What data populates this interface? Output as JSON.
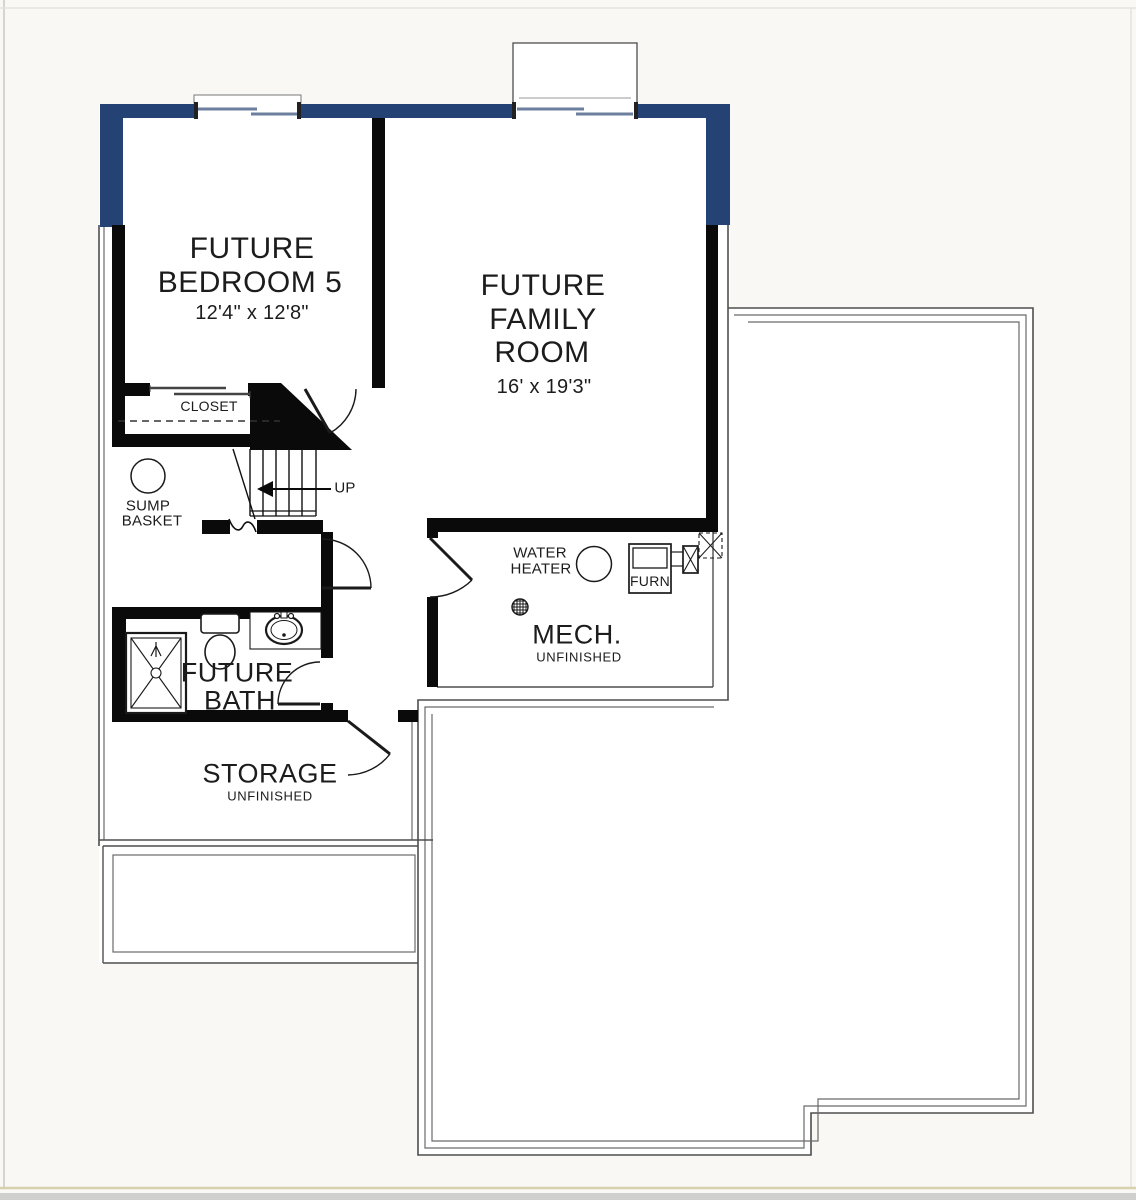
{
  "title": "Basement floor plan",
  "colors": {
    "exterior_wall": "#254274",
    "interior_wall": "#0a0a0a",
    "foundation_line": "#5c5c5c",
    "page_border_bottom": "#d8d2ac",
    "window_sash": "#6c7f9e"
  },
  "rooms": {
    "bedroom": {
      "name_line1": "FUTURE",
      "name_line2": "BEDROOM 5",
      "dimensions": "12'4\" x 12'8\""
    },
    "family_room": {
      "name_line1": "FUTURE",
      "name_line2": "FAMILY",
      "name_line3": "ROOM",
      "dimensions": "16' x 19'3\""
    },
    "closet": {
      "name": "CLOSET"
    },
    "stairs": {
      "direction_label": "UP"
    },
    "sump_basket": {
      "name_line1": "SUMP",
      "name_line2": "BASKET"
    },
    "mech_room": {
      "name": "MECH.",
      "status": "UNFINISHED",
      "water_heater_line1": "WATER",
      "water_heater_line2": "HEATER",
      "furnace_label": "FURN"
    },
    "bath": {
      "name_line1": "FUTURE",
      "name_line2": "BATH"
    },
    "storage": {
      "name": "STORAGE",
      "status": "UNFINISHED"
    }
  }
}
